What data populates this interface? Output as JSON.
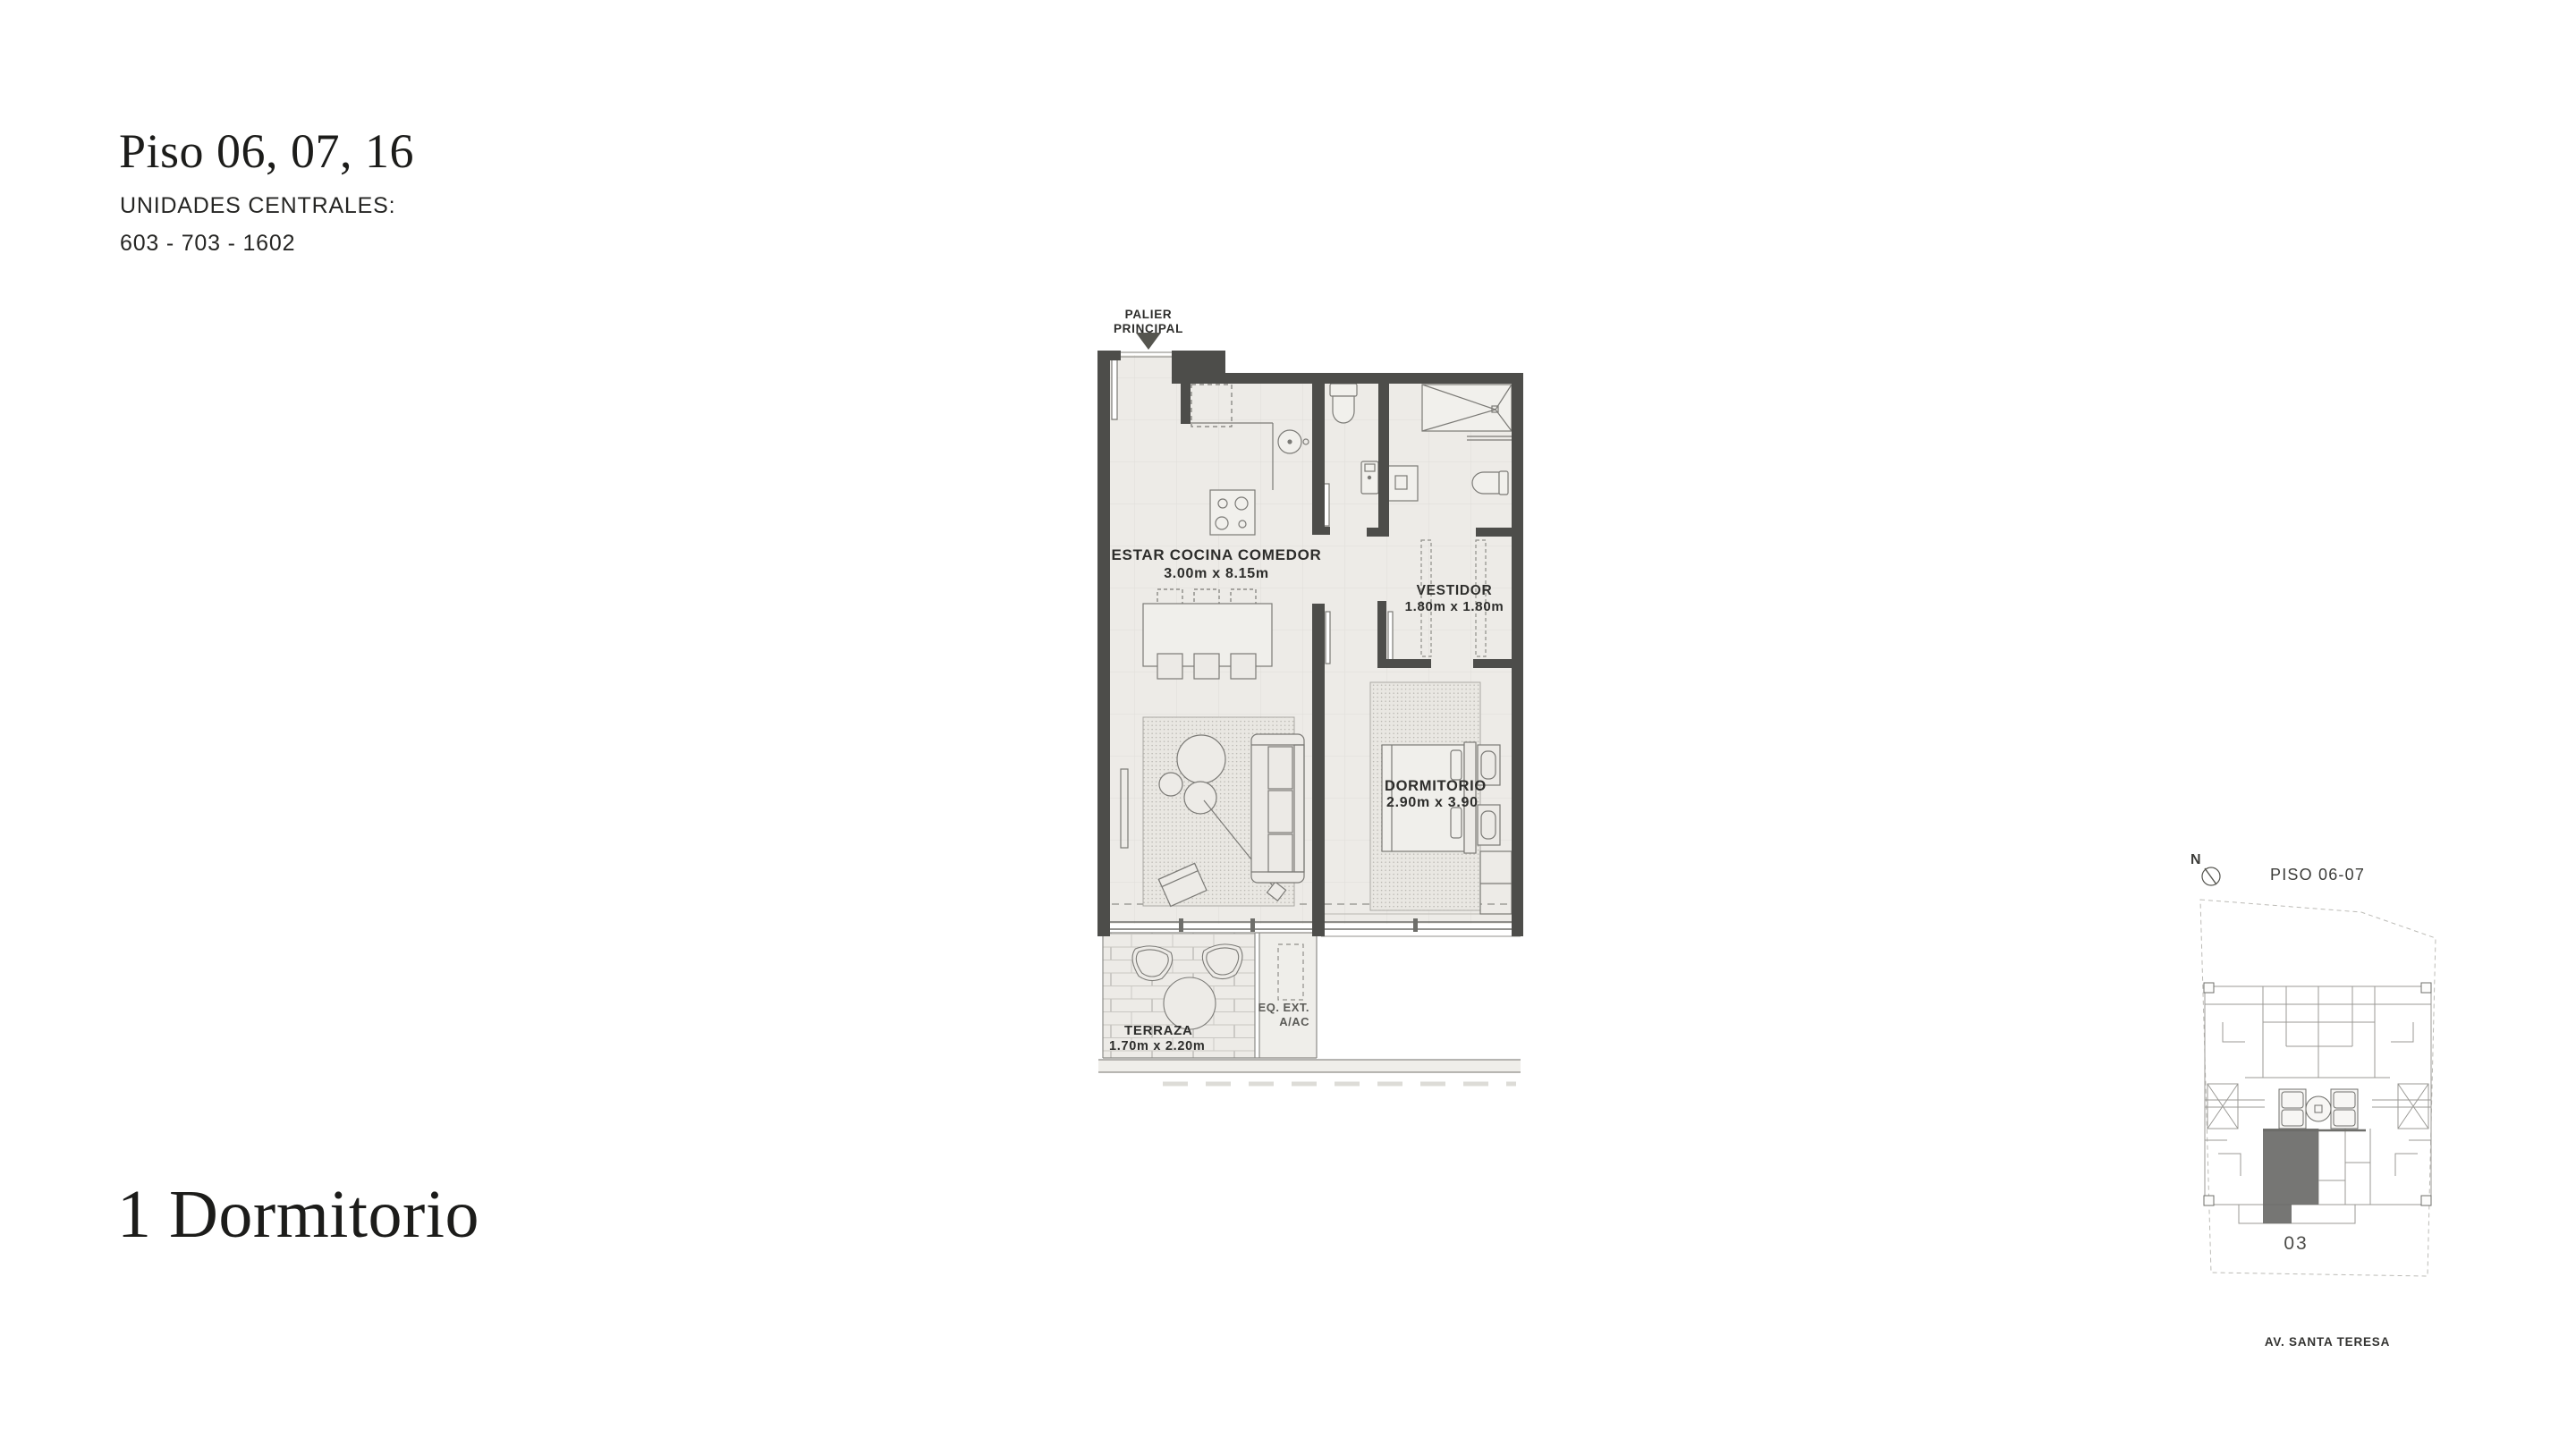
{
  "header": {
    "title": "Piso 06, 07, 16",
    "subtitle": "UNIDADES CENTRALES:",
    "units": "603 - 703 - 1602"
  },
  "typology": {
    "title": "1 Dormitorio"
  },
  "plan": {
    "entry": {
      "line1": "PALIER",
      "line2": "PRINCIPAL"
    },
    "living": {
      "name": "ESTAR COCINA COMEDOR",
      "dims": "3.00m x 8.15m"
    },
    "vestidor": {
      "name": "VESTIDOR",
      "dims": "1.80m x 1.80m"
    },
    "dormitorio": {
      "name": "DORMITORIO",
      "dims": "2.90m x 3.90"
    },
    "terraza": {
      "name": "TERRAZA",
      "dims": "1.70m x 2.20m"
    },
    "equipment": {
      "line1": "EQ. EXT.",
      "line2": "A/AC"
    }
  },
  "keyplan": {
    "compass": "N",
    "title": "PISO 06-07",
    "unit": "03",
    "street": "AV. SANTA TERESA"
  },
  "colors": {
    "wall": "#4d4d4a",
    "floor": "#edebe7",
    "furniture_line": "#7b7a76",
    "label_text": "#2d2d2b",
    "keyplan_line": "#9b9a96",
    "keyplan_highlight": "#6c6c69"
  }
}
